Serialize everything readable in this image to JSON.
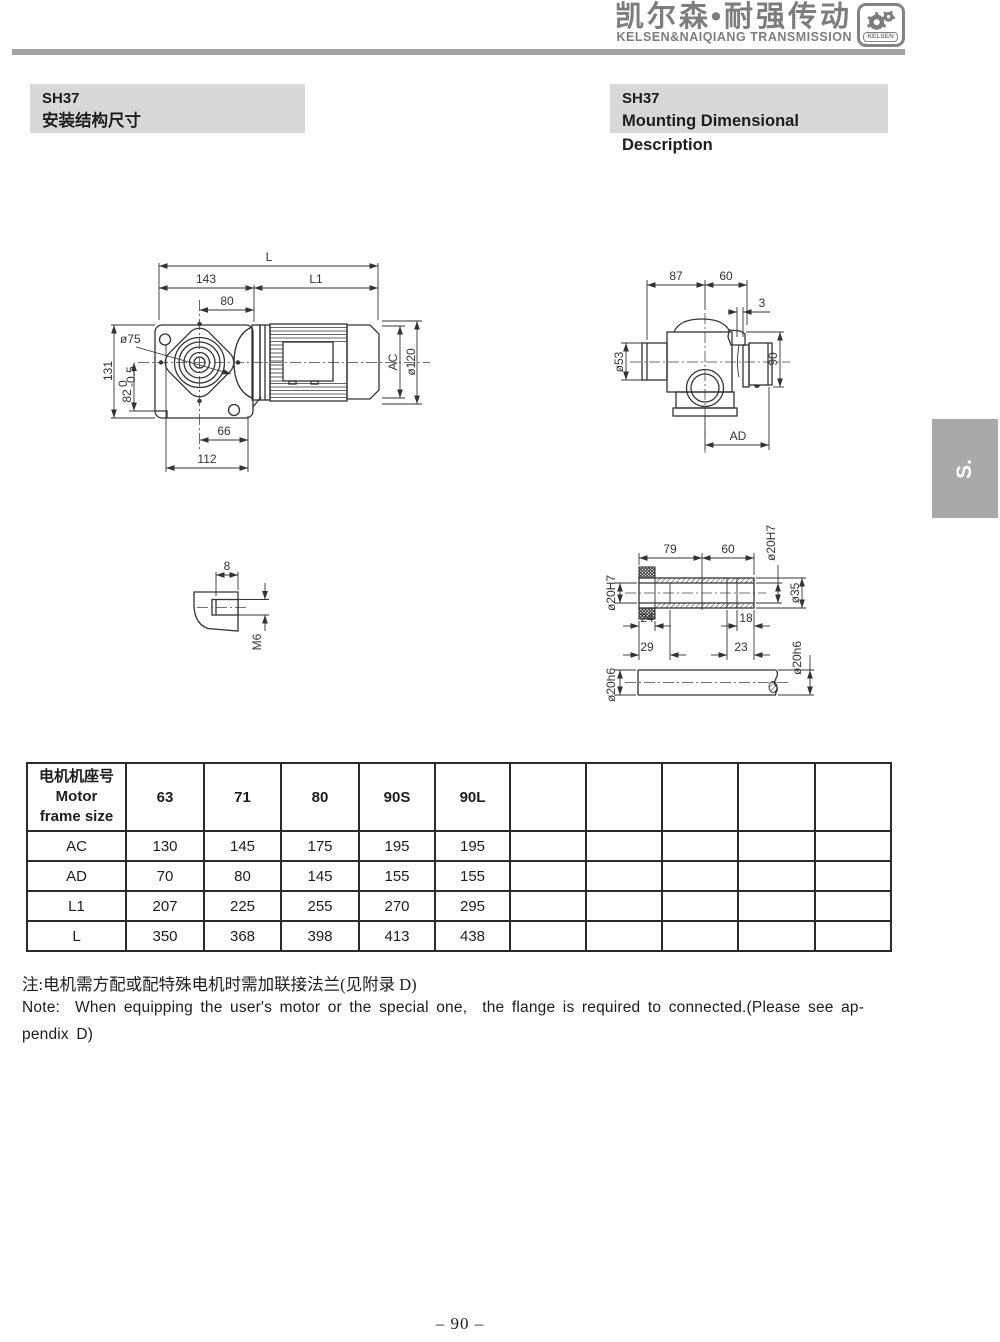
{
  "header": {
    "brand_cn": "凯尔森•耐强传动",
    "brand_en": "KELSEN&NAIQIANG TRANSMISSION",
    "logo_text": "KELSEN"
  },
  "titles": {
    "left": {
      "model": "SH37",
      "subtitle": "安装结构尺寸"
    },
    "right": {
      "model": "SH37",
      "subtitle": "Mounting Dimensional Description"
    }
  },
  "side_tab": {
    "label": "S."
  },
  "drawings": {
    "front_view": {
      "labels": {
        "L": "L",
        "n143": "143",
        "L1": "L1",
        "n80": "80",
        "dia75": "ø75",
        "n131": "131",
        "n82": "82",
        "tol_up": "0",
        "tol_dn": "-0.5",
        "n66": "66",
        "n112": "112",
        "AC": "AC",
        "dia120": "ø120"
      }
    },
    "side_view": {
      "labels": {
        "n87": "87",
        "n60": "60",
        "n3": "3",
        "dia53": "ø53",
        "n90": "90",
        "AD": "AD"
      }
    },
    "tap_detail": {
      "labels": {
        "n8": "8",
        "M6": "M6"
      }
    },
    "shaft_detail": {
      "labels": {
        "n79": "79",
        "n60": "60",
        "dia20H7_top": "ø20H7",
        "dia20H7_left": "ø20H7",
        "dia35": "ø35",
        "n24": "24",
        "n18": "18",
        "n29": "29",
        "n23": "23",
        "dia20h6_right": "ø20h6",
        "dia20h6_left": "ø20h6"
      }
    }
  },
  "table": {
    "header_col": [
      "电机机座号",
      "Motor",
      "frame size"
    ],
    "columns": [
      "63",
      "71",
      "80",
      "90S",
      "90L",
      "",
      "",
      "",
      "",
      ""
    ],
    "rows": [
      {
        "label": "AC",
        "values": [
          "130",
          "145",
          "175",
          "195",
          "195",
          "",
          "",
          "",
          "",
          ""
        ]
      },
      {
        "label": "AD",
        "values": [
          "70",
          "80",
          "145",
          "155",
          "155",
          "",
          "",
          "",
          "",
          ""
        ]
      },
      {
        "label": "L1",
        "values": [
          "207",
          "225",
          "255",
          "270",
          "295",
          "",
          "",
          "",
          "",
          ""
        ]
      },
      {
        "label": "L",
        "values": [
          "350",
          "368",
          "398",
          "413",
          "438",
          "",
          "",
          "",
          "",
          ""
        ]
      }
    ]
  },
  "notes": {
    "zh": "注:电机需方配或配特殊电机时需加联接法兰(见附录 D)",
    "en_line1": "Note:  When equipping the user's motor or the special one,  the flange is required to connected.(Please see ap-",
    "en_line2": "pendix D)"
  },
  "page": {
    "number": "– 90 –"
  },
  "colors": {
    "brand_gray": "#7d7d7d",
    "rule_gray": "#a3a3a3",
    "block_bg": "#d8d8d8",
    "tab_bg": "#a9a9a9",
    "line_ink": "#333333"
  }
}
